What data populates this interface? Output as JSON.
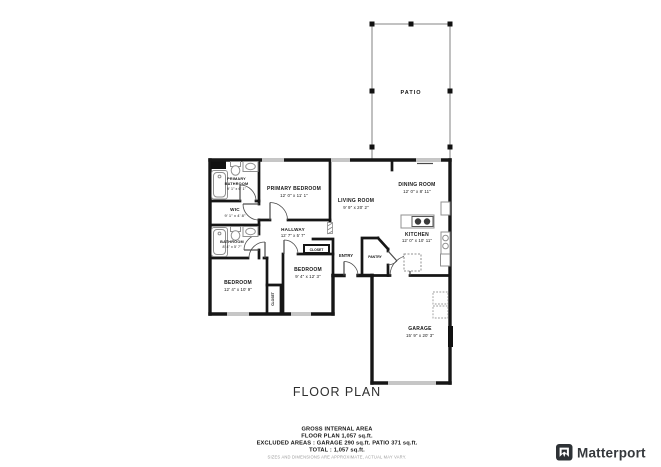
{
  "title": "FLOOR PLAN",
  "rooms": {
    "patio": {
      "name": "PATIO"
    },
    "primary_bathroom": {
      "name_lines": [
        "PRIMARY",
        "BATHROOM"
      ],
      "dims": "9' 1\" x 6' 1\""
    },
    "wic": {
      "name": "WIC",
      "dims": "9' 1\" x 4' 8\""
    },
    "bathroom": {
      "name": "BATHROOM",
      "dims": "8' 4\" x 5' 7\""
    },
    "primary_bedroom": {
      "name": "PRIMARY BEDROOM",
      "dims": "12' 0\" x 11' 1\""
    },
    "living_room": {
      "name": "LIVING ROOM",
      "dims": "9' 9\" x 20' 2\""
    },
    "dining_room": {
      "name": "DINING ROOM",
      "dims": "12' 0\" x 8' 11\""
    },
    "kitchen": {
      "name": "KITCHEN",
      "dims": "12' 0\" x 10' 11\""
    },
    "hallway": {
      "name": "HALLWAY",
      "dims": "12' 7\" x 5' 7\""
    },
    "closet_hallway": {
      "name": "CLOSET"
    },
    "closet_bedroom": {
      "name": "CLOSET"
    },
    "bedroom_left": {
      "name": "BEDROOM",
      "dims": "12' 4\" x 10' 9\""
    },
    "bedroom_middle": {
      "name": "BEDROOM",
      "dims": "9' 4\" x 12' 3\""
    },
    "entry": {
      "name": "ENTRY"
    },
    "pantry": {
      "name": "PANTRY"
    },
    "garage": {
      "name": "GARAGE",
      "dims": "15' 9\" x 20' 3\""
    }
  },
  "footer": {
    "line1": "GROSS INTERNAL AREA",
    "line2": "FLOOR PLAN 1,057 sq.ft.",
    "line3": "EXCLUDED AREAS :  GARAGE 290 sq.ft.   PATIO 371 sq.ft.",
    "line4": "TOTAL :  1,057 sq.ft.",
    "disclaimer": "SIZES AND DIMENSIONS ARE APPROXIMATE, ACTUAL MAY VARY."
  },
  "branding": {
    "name": "Matterport"
  },
  "colors": {
    "wall": "#161616",
    "window": "#c6c6c6",
    "fixture": "#909090",
    "patio_line": "#9e9e9e",
    "logo_bg": "#2e3236",
    "text": "#161616",
    "disclaimer_text": "#9c9c9c",
    "background": "#ffffff"
  }
}
